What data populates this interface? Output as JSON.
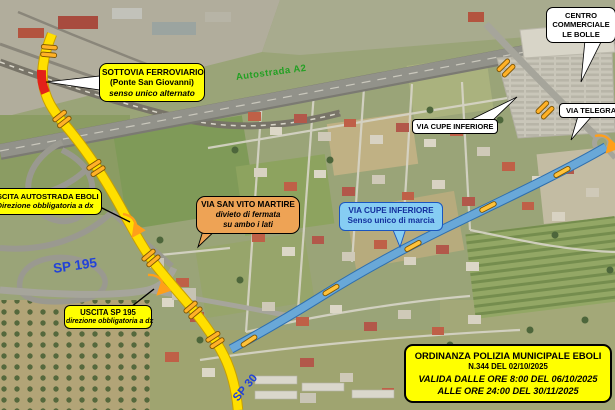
{
  "map": {
    "road_labels": {
      "autostrada": "Autostrada A2",
      "sp195": "SP 195",
      "sp30": "SP 30"
    },
    "callouts": {
      "sottovia": {
        "l1": "SOTTOVIA FERROVIARIO",
        "l2": "(Ponte San Giovanni)",
        "l3": "senso unico alternato"
      },
      "centro_commerciale": {
        "l1": "CENTRO",
        "l2": "COMMERCIALE",
        "l3": "LE BOLLE"
      },
      "via_cupe_name": {
        "l1": "VIA CUPE INFERIORE"
      },
      "via_telegrafo": {
        "l1": "VIA TELEGRAFO"
      },
      "uscita_autostrada": {
        "l1": "USCITA AUTOSTRADA EBOLI",
        "l2": "Direzione obbligatoria a dx"
      },
      "via_san_vito": {
        "l1": "VIA SAN VITO MARTIRE",
        "l2": "divieto di fermata",
        "l3": "su ambo i lati"
      },
      "via_cupe_oneway": {
        "l1": "VIA CUPE INFERIORE",
        "l2": "Senso unico di marcia"
      },
      "uscita_sp195": {
        "l1": "USCITA SP 195",
        "l2": "direzione obbligatoria a dx"
      }
    },
    "ordinance": {
      "l1": "ORDINANZA POLIZIA MUNICIPALE EBOLI",
      "l2": "N.344 DEL 02/10/2025",
      "l3": "VALIDA DALLE ORE 8:00 DEL 06/10/2025",
      "l4": "ALLE ORE 24:00 DEL 30/11/2025"
    },
    "legend_colors": {
      "route_closed_yellow": "#ffdf00",
      "closed_segment_red": "#e32119",
      "route_oneway_blue": "#69a8d8",
      "marker_orange": "#ffb127",
      "callout_yellow": "#ffff00",
      "callout_orange": "#eea355",
      "callout_blue_bg": "#86cdf3",
      "callout_blue_text": "#13309d",
      "label_green": "#23a023",
      "label_blue": "#2142d8"
    }
  }
}
